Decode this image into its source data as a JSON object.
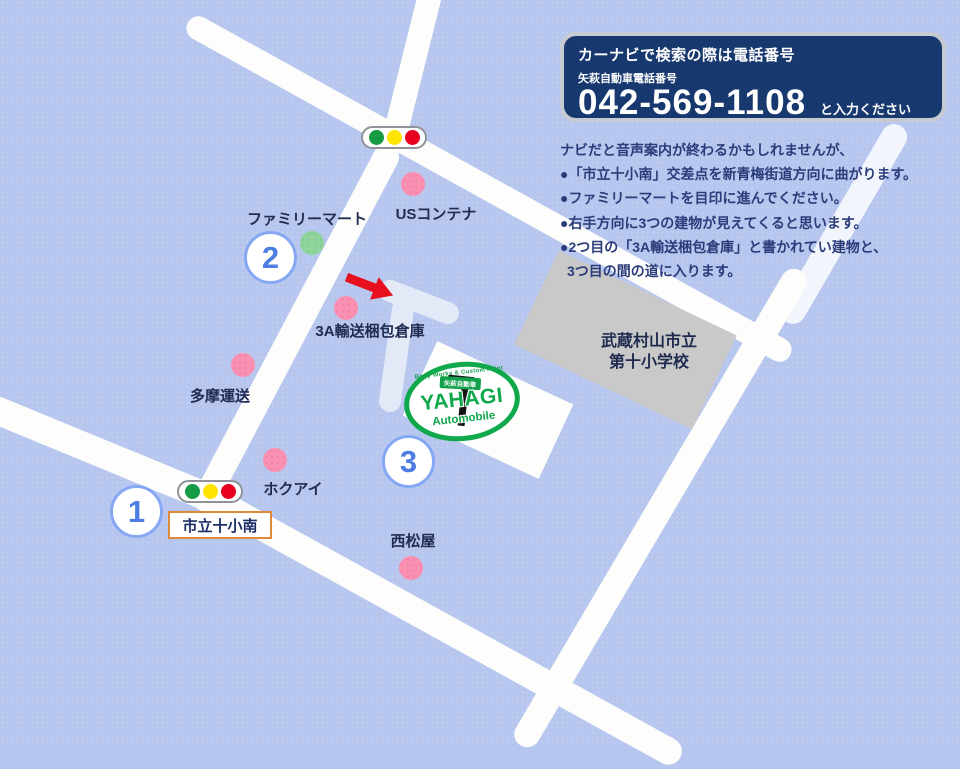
{
  "info_box": {
    "title": "カーナビで検索の際は電話番号",
    "subtitle": "矢萩自動車電話番号",
    "phone": "042-569-1108",
    "suffix": "と入力ください"
  },
  "instructions": {
    "intro": "ナビだと音声案内が終わるかもしれませんが、",
    "steps": [
      "●「市立十小南」交差点を新青梅街道方向に曲がります。",
      "●ファミリーマートを目印に進んでください。",
      "●右手方向に3つの建物が見えてくると思います。",
      "●2つ目の「3A輸送梱包倉庫」と書かれてい建物と、",
      "3つ目の間の道に入ります。"
    ]
  },
  "landmarks": [
    {
      "label": "USコンテナ",
      "marker": "pink"
    },
    {
      "label": "ファミリーマート",
      "marker": "green"
    },
    {
      "label": "3A輸送梱包倉庫",
      "marker": "pink"
    },
    {
      "label": "多摩運送",
      "marker": "pink"
    },
    {
      "label": "ホクアイ",
      "marker": "pink"
    },
    {
      "label": "西松屋",
      "marker": "pink"
    }
  ],
  "school": {
    "name_line1": "武蔵村山市立",
    "name_line2": "第十小学校"
  },
  "intersection_label": "市立十小南",
  "waypoints": [
    "1",
    "2",
    "3"
  ],
  "logo": {
    "arc_text": "Body Works & Custom Paint",
    "badge": "矢萩自動車",
    "name": "YAHAGI",
    "sub": "Automobile"
  },
  "colors": {
    "background": "#b7c6ee",
    "road": "#fdfefc",
    "light_road": "#e3e9f7",
    "school_fill": "#c9c9c9",
    "pink_marker": "#f98fb1",
    "green_marker": "#8fd49c",
    "info_box_navy": "#17386e",
    "logo_green": "#0fa84b",
    "arrow_red": "#e8101f",
    "waypoint_blue": "#86a8f4",
    "intersection_border_orange": "#e28a3c"
  }
}
